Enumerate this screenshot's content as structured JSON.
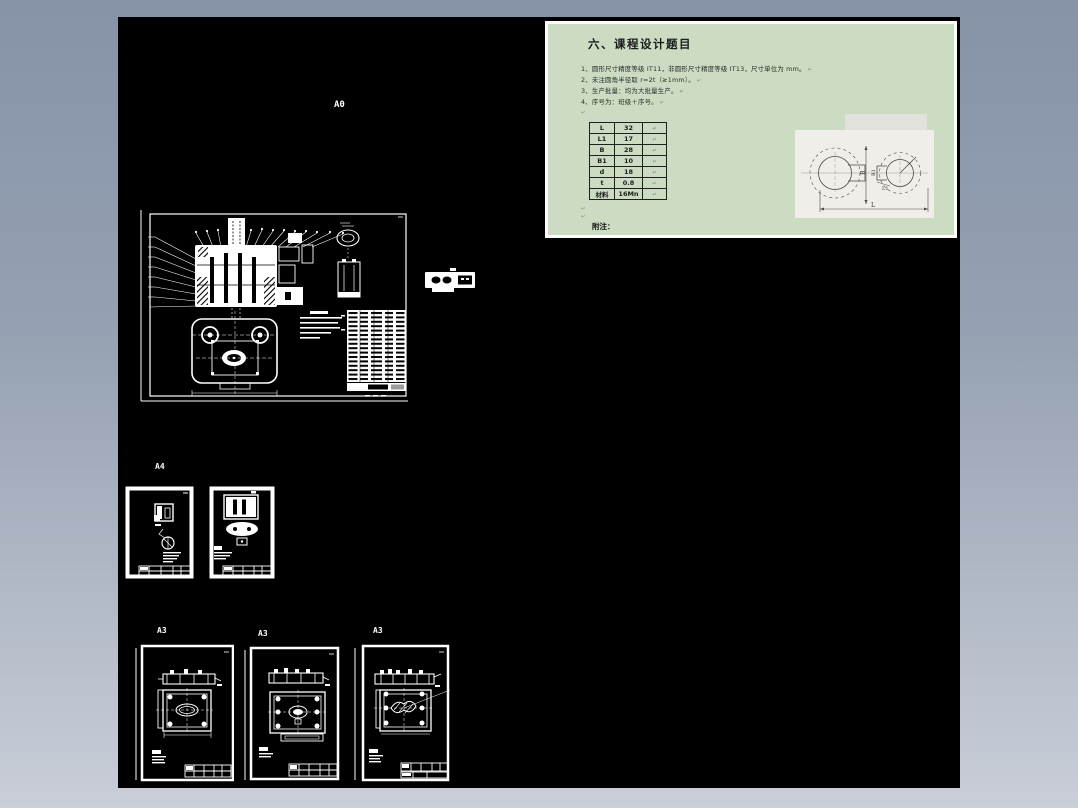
{
  "colors": {
    "frame_top": "#8693a8",
    "frame_bottom": "#c9ced8",
    "canvas": "#000000",
    "panel_green": "#cbdcc3",
    "linework": "#ffffff"
  },
  "notes_panel": {
    "title": "六、课程设计题目",
    "items": [
      "1、圆形尺寸精度等级 IT11，非圆形尺寸精度等级 IT13，尺寸单位为 mm。",
      "2、未注圆角半径取 r=2t（≥1mm）。",
      "3、生产批量：均为大批量生产。",
      "4、序号为：班级＋序号。"
    ],
    "paragraph_mark": "↵",
    "table": {
      "rows": [
        {
          "name": "L",
          "value": "32"
        },
        {
          "name": "L1",
          "value": "17"
        },
        {
          "name": "B",
          "value": "28"
        },
        {
          "name": "B1",
          "value": "10"
        },
        {
          "name": "d",
          "value": "18"
        },
        {
          "name": "t",
          "value": "0.8"
        },
        {
          "name": "材料",
          "value": "16Mn"
        }
      ]
    },
    "footnote": "附注：",
    "figure": {
      "dim_b": "B",
      "dim_b1": "B1",
      "dim_l": "L",
      "dim_l1": "L1"
    }
  },
  "sheets": {
    "a0": {
      "label": "A0"
    },
    "a4": {
      "label": "A4"
    },
    "a3_1": {
      "label": "A3"
    },
    "a3_2": {
      "label": "A3"
    },
    "a3_3": {
      "label": "A3"
    }
  }
}
